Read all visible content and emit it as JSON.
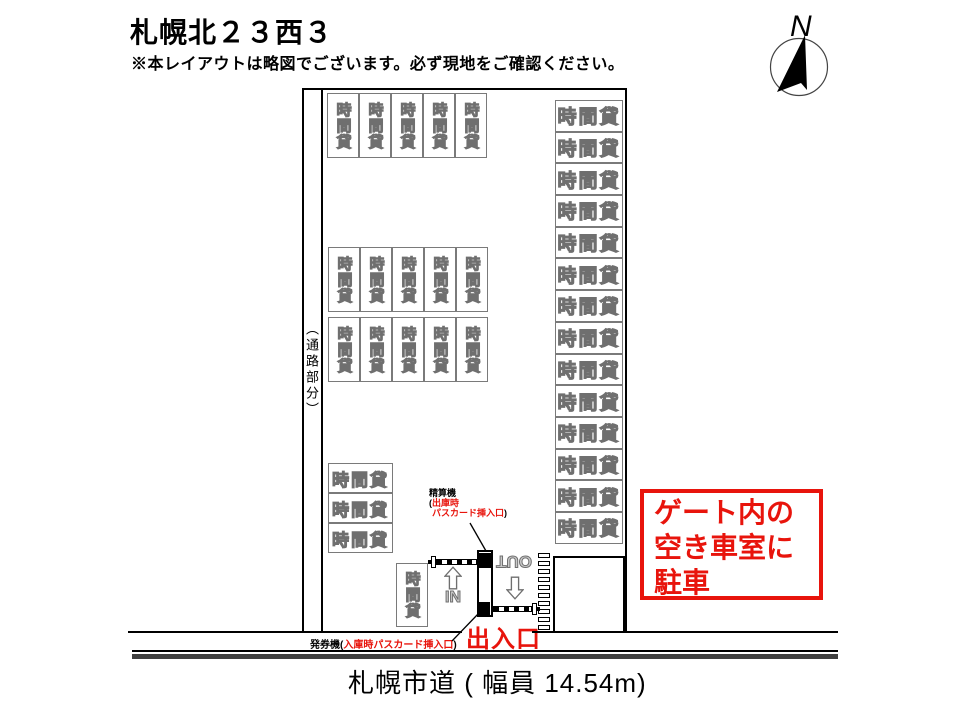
{
  "header": {
    "title": "札幌北２３西３",
    "disclaimer": "※本レイアウトは略図でございます。必ず現地をご確認ください。"
  },
  "compass": {
    "north_label": "N"
  },
  "lot": {
    "aisle_label": "（通路部分）",
    "stall_label": "時間貸",
    "stall_groups": [
      {
        "name": "top-row",
        "orientation": "vertical",
        "count": 5
      },
      {
        "name": "middle-row-upper",
        "orientation": "vertical",
        "count": 5
      },
      {
        "name": "middle-row-lower",
        "orientation": "vertical",
        "count": 5
      },
      {
        "name": "southwest-stack",
        "orientation": "horizontal",
        "count": 3
      },
      {
        "name": "gate-side-stall",
        "orientation": "vertical",
        "count": 1
      },
      {
        "name": "east-column",
        "orientation": "horizontal",
        "count": 14
      }
    ]
  },
  "gate": {
    "in_label": "IN",
    "out_label": "OUT",
    "entrance_label": "出入口",
    "pay_machine_label": {
      "name": "精算機",
      "paren_open": "(",
      "red_line1": "出庫時",
      "red_line2": "パスカード挿入口",
      "paren_close": ")"
    },
    "ticket_machine_label": {
      "name": "発券機",
      "paren_open": "(",
      "red_text": "入庫時パスカード挿入口",
      "paren_close": ")"
    }
  },
  "notice_box": {
    "lines": [
      "ゲート内の",
      "空き車室に",
      "駐車"
    ]
  },
  "road": {
    "label": "札幌市道 ( 幅員 14.54m)"
  },
  "colors": {
    "accent_red": "#e8140c",
    "stall_gray": "#6f6f6f",
    "road_bar": "#3f3f3f"
  }
}
